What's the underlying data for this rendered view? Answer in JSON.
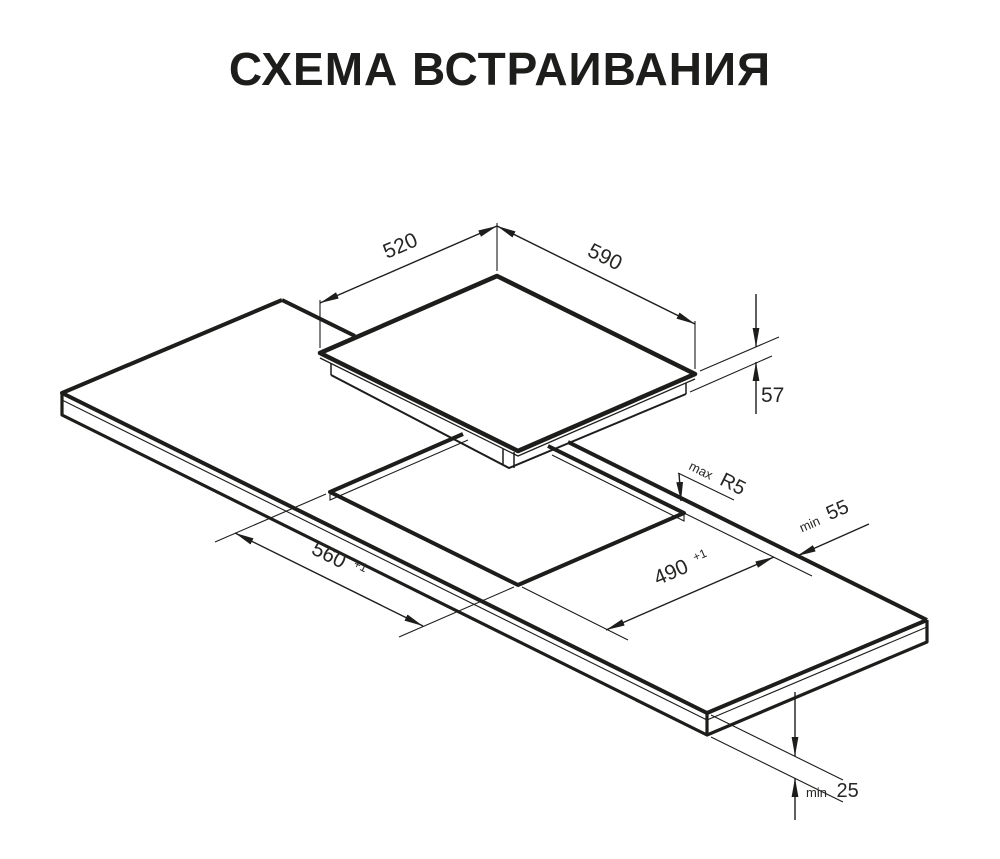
{
  "title": "СХЕМА ВСТРАИВАНИЯ",
  "colors": {
    "ink": "#1d1d1b",
    "paper": "#ffffff"
  },
  "diagram": {
    "labels": {
      "hob_depth": "520",
      "hob_width": "590",
      "hob_height": "57",
      "corner_radius_prefix": "max",
      "corner_radius_value": "R5",
      "rear_clearance_prefix": "min",
      "rear_clearance_value": "55",
      "cutout_length_value": "560",
      "cutout_length_tolerance": "+1",
      "cutout_width_value": "490",
      "cutout_width_tolerance": "+1",
      "worktop_thickness_prefix": "min",
      "worktop_thickness_value": "25"
    }
  }
}
